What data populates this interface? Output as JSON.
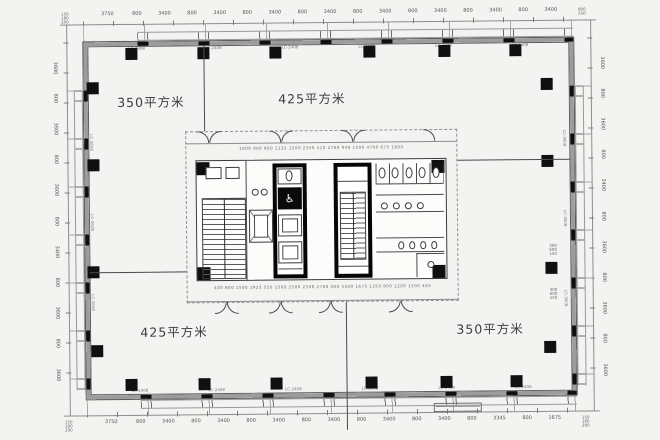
{
  "plan": {
    "areas": {
      "top_left": "350平方米",
      "top_right": "425平方米",
      "bottom_left": "425平方米",
      "bottom_right": "350平方米"
    },
    "accessible_icon": "♿"
  },
  "dims": {
    "top": [
      "3750",
      "800",
      "3400",
      "800",
      "3400",
      "800",
      "3400",
      "800",
      "3400",
      "800",
      "3400",
      "800",
      "3400",
      "800",
      "3400",
      "800",
      "3400"
    ],
    "bottom": [
      "3750",
      "800",
      "3400",
      "800",
      "3400",
      "800",
      "3400",
      "800",
      "3400",
      "800",
      "3400",
      "800",
      "3400",
      "800",
      "3345",
      "800",
      "1675"
    ],
    "left": [
      "3600",
      "800",
      "3600",
      "800",
      "3600",
      "800",
      "3400",
      "800",
      "3600",
      "800",
      "3600"
    ],
    "right": [
      "3600",
      "800",
      "3600",
      "800",
      "3400",
      "800",
      "3600",
      "800",
      "3600",
      "800",
      "3600"
    ],
    "corner_tl": [
      "150",
      "180",
      "200"
    ],
    "corner_tr": [
      "800",
      "350"
    ],
    "corner_bl": [
      "150",
      "180",
      "200"
    ],
    "corner_br": [
      "150",
      "180",
      "200"
    ],
    "right_stack_1": [
      "300",
      "600",
      "150"
    ],
    "right_stack_2": [
      "300",
      "600",
      "150"
    ],
    "core_top": "1000 900 800 1125 1500 2350 510 2700 940 1500 4700 675 1600",
    "core_bottom": "400 800 1500 1925 550 1500 2500 2300 2700 300 3300 1675 1350 800 1200 1500 450"
  },
  "labels": {
    "top_wall": [
      "LC-2408",
      "LC-2408",
      "LC-2408",
      "LC-2408",
      "LC-2408",
      "LC-2408"
    ],
    "bottom_wall": [
      "LC-2408",
      "LC-2408",
      "LC-2408",
      "LC-2408",
      "LC-2408",
      "LC-2408"
    ],
    "left_wall": [
      "LC-3608",
      "LC-3608",
      "LC-3608"
    ],
    "right_wall": [
      "LC-3608",
      "LC-3608",
      "LC-3608"
    ]
  },
  "colors": {
    "paper": "#f3f3f1",
    "line": "#4a4a4a",
    "wall_fill": "#9c9c9c",
    "black": "#101010"
  }
}
